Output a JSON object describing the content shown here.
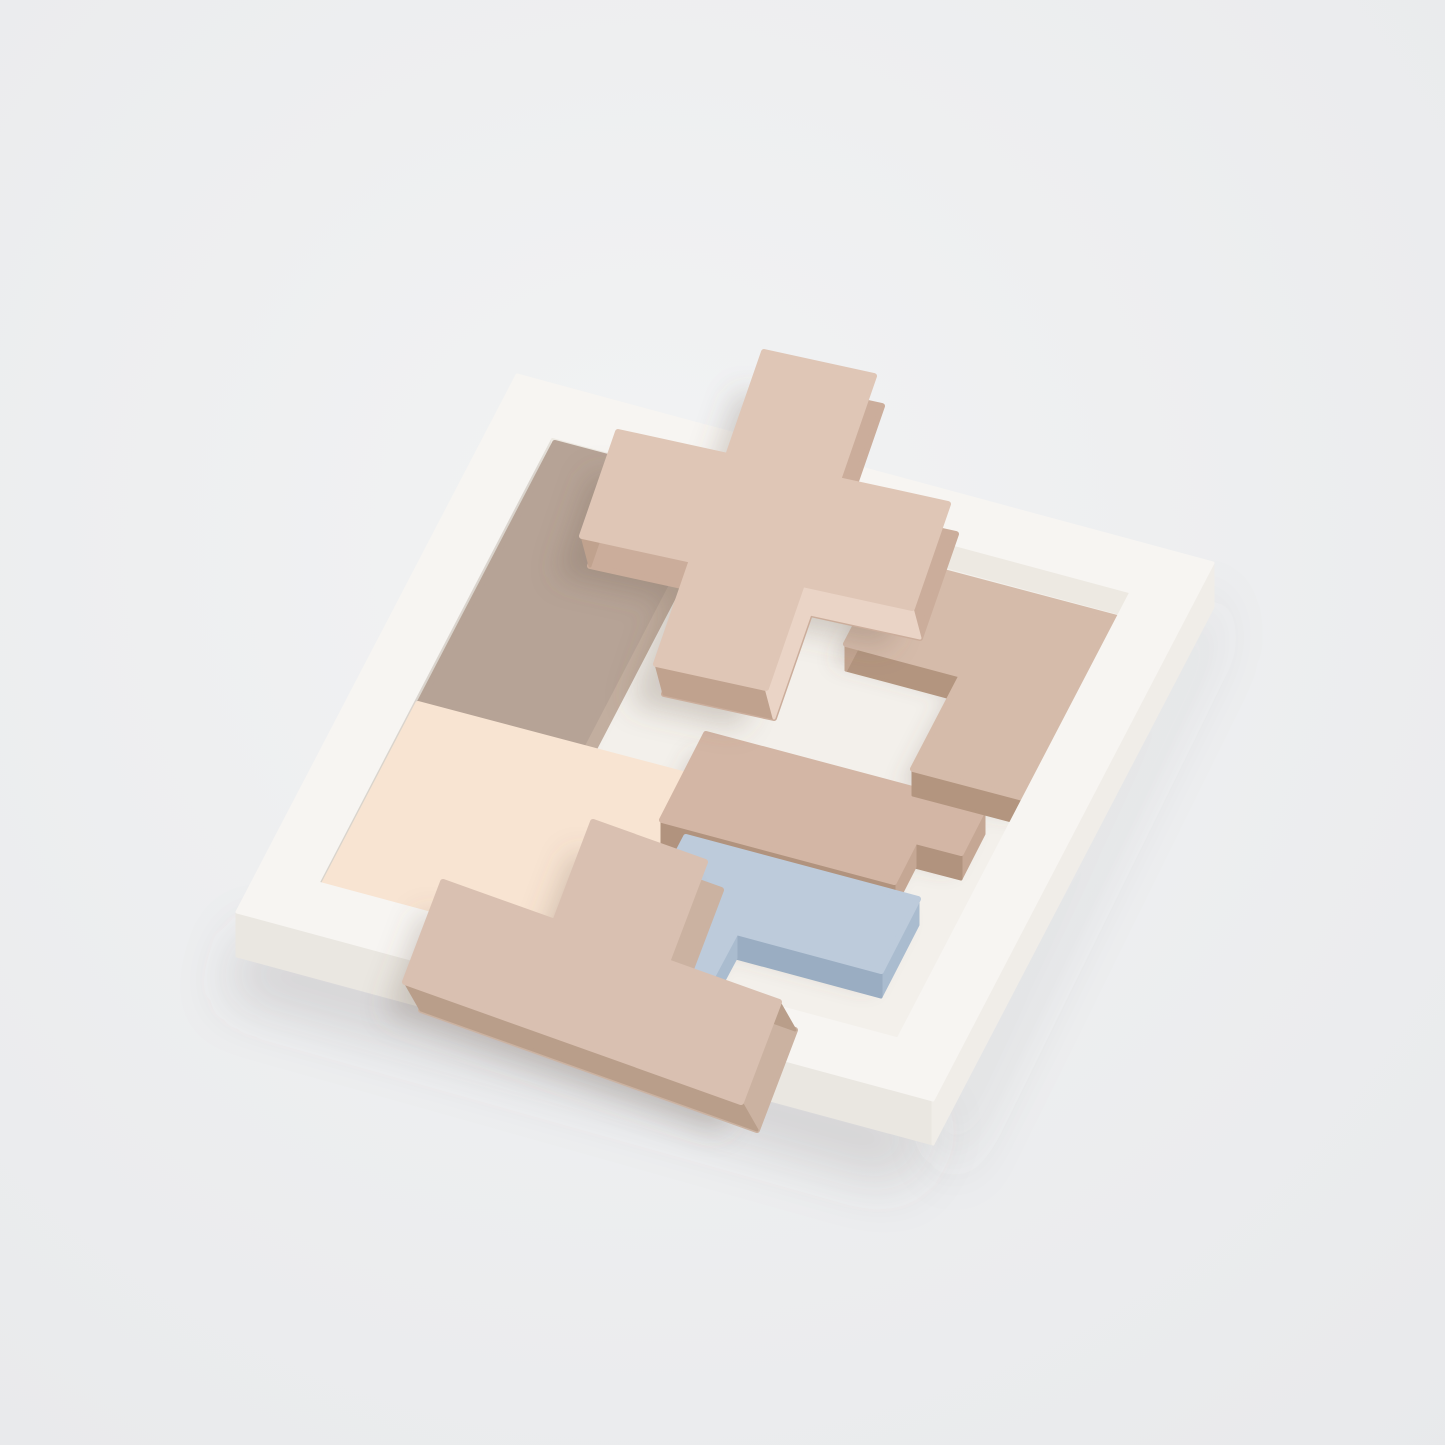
{
  "image": {
    "kind": "product-photo",
    "description": "Pastel wooden pentomino puzzle pieces in a white square wooden tray on a light gray backdrop; a blush plus-shaped piece rests tilted on top of the pieces and a blush T-shaped piece leans against the tray's front edge.",
    "width": 1445,
    "height": 1445
  },
  "objects": {
    "tray_label": "white wooden tray",
    "piece_labels": [
      "taupe rectangle piece",
      "cream zigzag piece",
      "blush plus piece",
      "beige corner piece",
      "beige bar piece",
      "light blue corner piece",
      "blush T piece"
    ]
  },
  "colors": {
    "background_center": "#f2f3f4",
    "background_edge": "#e8e9eb",
    "tray": {
      "top": "#f7f5f2",
      "side_left": "#eae7e1",
      "side_right": "#f0ede8",
      "wall_left": "#e5e1da",
      "wall_right": "#ede9e2",
      "floor": "#f3f0eb"
    },
    "shadows": {
      "ground": "rgba(99,94,88,0.18)",
      "ground2": "rgba(99,94,88,0.10)",
      "contact": "rgba(110,92,80,0.22)",
      "cast": "rgba(110,92,80,0.26)"
    },
    "pieces": {
      "rectangle": {
        "top": "#b6a396",
        "side": "#c2ae9f",
        "end": "#9c8b7e"
      },
      "cream": {
        "top": "#f8e4d2",
        "side": "#f0d7c1",
        "end": "#e1c3aa"
      },
      "plus": {
        "top": "#dfc6b6",
        "side": "#cbad9b",
        "side_light": "#ead4c6",
        "end": "#c0a28e"
      },
      "corner": {
        "top": "#d5bbaa",
        "side": "#c2a490",
        "end": "#b3957f"
      },
      "bar": {
        "top": "#d3b6a5",
        "side": "#c5a794",
        "end": "#b1937e"
      },
      "blue": {
        "top": "#bdcbdb",
        "side": "#aabccf",
        "end": "#9aadc2"
      },
      "tee": {
        "top": "#d9c0b1",
        "side": "#cbb2a1",
        "end": "#b99e8a"
      }
    }
  }
}
